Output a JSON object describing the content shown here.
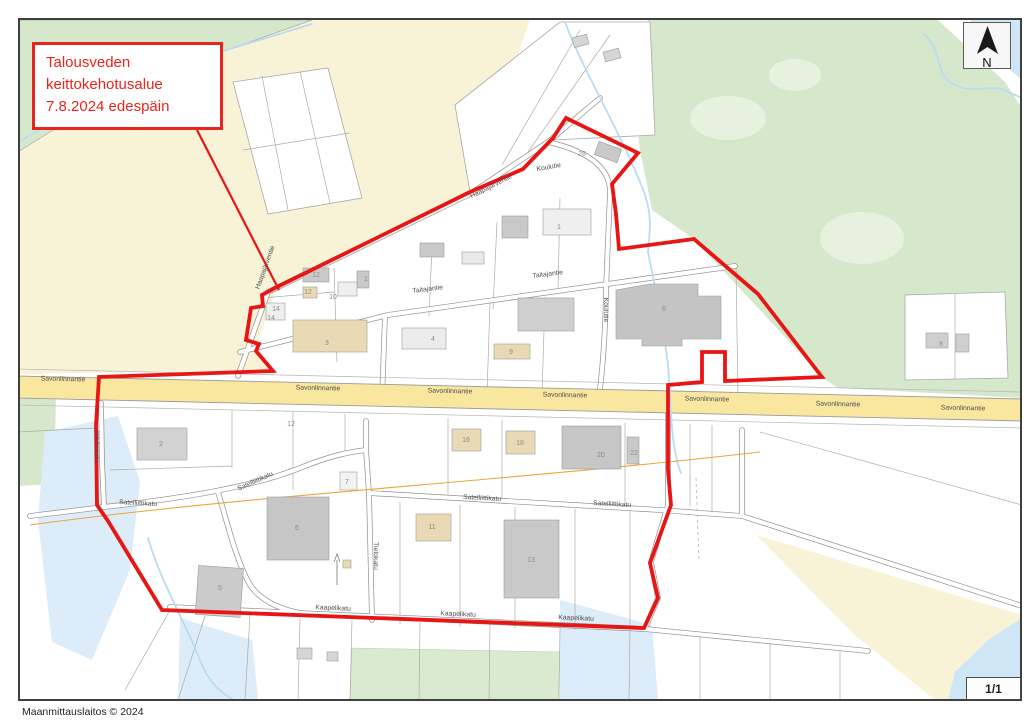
{
  "advisory_box": {
    "line1": "Talousveden",
    "line2": "keittokehotusalue",
    "line3": "7.8.2024 edespäin"
  },
  "north_indicator": {
    "label": "N"
  },
  "page_indicator": "1/1",
  "attribution": "Maanmittauslaitos © 2024",
  "colors": {
    "boundary_red": "#e81515",
    "label_red": "#e8251c",
    "road_yellow": "#f9e7a0",
    "field_yellow": "#f8f3d6",
    "forest_green": "#d6e8cb",
    "forest_green_light": "#e7f2de",
    "water_blue": "#cfe6f6",
    "water_pale": "#dcecf8",
    "stream_blue": "#b9dcf2",
    "powerline_orange": "#eda53c",
    "building_gray": "#c9c9c9",
    "building_tan": "#e9d9b4"
  },
  "street_labels": [
    {
      "text": "Savonlinnantie",
      "x": 63,
      "y": 381,
      "rot": 1.3
    },
    {
      "text": "Savonlinnantie",
      "x": 318,
      "y": 390,
      "rot": 1.3
    },
    {
      "text": "Savonlinnantie",
      "x": 450,
      "y": 393,
      "rot": 1.3
    },
    {
      "text": "Savonlinnantie",
      "x": 565,
      "y": 397,
      "rot": 1.3
    },
    {
      "text": "Savonlinnantie",
      "x": 707,
      "y": 401,
      "rot": 1.3
    },
    {
      "text": "Savonlinnantie",
      "x": 838,
      "y": 406,
      "rot": 1.3
    },
    {
      "text": "Savonlinnantie",
      "x": 963,
      "y": 410,
      "rot": 1.3
    },
    {
      "text": "Taitajantie",
      "x": 428,
      "y": 291,
      "rot": -7
    },
    {
      "text": "Taitajantie",
      "x": 548,
      "y": 276,
      "rot": -7
    },
    {
      "text": "Haapajärventie",
      "x": 492,
      "y": 188,
      "rot": -27
    },
    {
      "text": "Haapajärventie",
      "x": 267,
      "y": 268,
      "rot": -70
    },
    {
      "text": "Koulutie",
      "x": 549,
      "y": 169,
      "rot": -10
    },
    {
      "text": "Koulutie",
      "x": 604,
      "y": 310,
      "rot": 90
    },
    {
      "text": "Satelliittikatu",
      "x": 138,
      "y": 505,
      "rot": 3
    },
    {
      "text": "Satelliittikatu",
      "x": 256,
      "y": 483,
      "rot": -24
    },
    {
      "text": "Satelliittikatu",
      "x": 482,
      "y": 500,
      "rot": 3
    },
    {
      "text": "Satelliittikatu",
      "x": 612,
      "y": 506,
      "rot": 3
    },
    {
      "text": "Kaapelikatu",
      "x": 333,
      "y": 610,
      "rot": 2.5
    },
    {
      "text": "Kaapelikatu",
      "x": 458,
      "y": 616,
      "rot": 2.5
    },
    {
      "text": "Kaapelikatu",
      "x": 576,
      "y": 620,
      "rot": 2.5
    },
    {
      "text": "Tietokatu",
      "x": 374,
      "y": 556,
      "rot": 90
    },
    {
      "text": "Johdinkatu",
      "x": 95,
      "y": 446,
      "rot": 90
    }
  ],
  "parcel_numbers": [
    {
      "text": "28",
      "x": 582,
      "y": 156
    },
    {
      "text": "1",
      "x": 559,
      "y": 229
    },
    {
      "text": "1",
      "x": 366,
      "y": 281
    },
    {
      "text": "12",
      "x": 316,
      "y": 277
    },
    {
      "text": "12",
      "x": 308,
      "y": 294
    },
    {
      "text": "10",
      "x": 333,
      "y": 299
    },
    {
      "text": "14",
      "x": 276,
      "y": 311
    },
    {
      "text": "14",
      "x": 271,
      "y": 320
    },
    {
      "text": "3",
      "x": 327,
      "y": 345
    },
    {
      "text": "4",
      "x": 433,
      "y": 341
    },
    {
      "text": "9",
      "x": 511,
      "y": 354
    },
    {
      "text": "6",
      "x": 664,
      "y": 311
    },
    {
      "text": "8",
      "x": 941,
      "y": 346
    },
    {
      "text": "2",
      "x": 161,
      "y": 446
    },
    {
      "text": "12",
      "x": 291,
      "y": 426
    },
    {
      "text": "16",
      "x": 466,
      "y": 442
    },
    {
      "text": "18",
      "x": 520,
      "y": 445
    },
    {
      "text": "20",
      "x": 601,
      "y": 457
    },
    {
      "text": "22",
      "x": 634,
      "y": 455
    },
    {
      "text": "11",
      "x": 432,
      "y": 529
    },
    {
      "text": "6",
      "x": 297,
      "y": 530
    },
    {
      "text": "13",
      "x": 531,
      "y": 562
    },
    {
      "text": "5",
      "x": 220,
      "y": 590
    },
    {
      "text": "7",
      "x": 347,
      "y": 484
    }
  ]
}
